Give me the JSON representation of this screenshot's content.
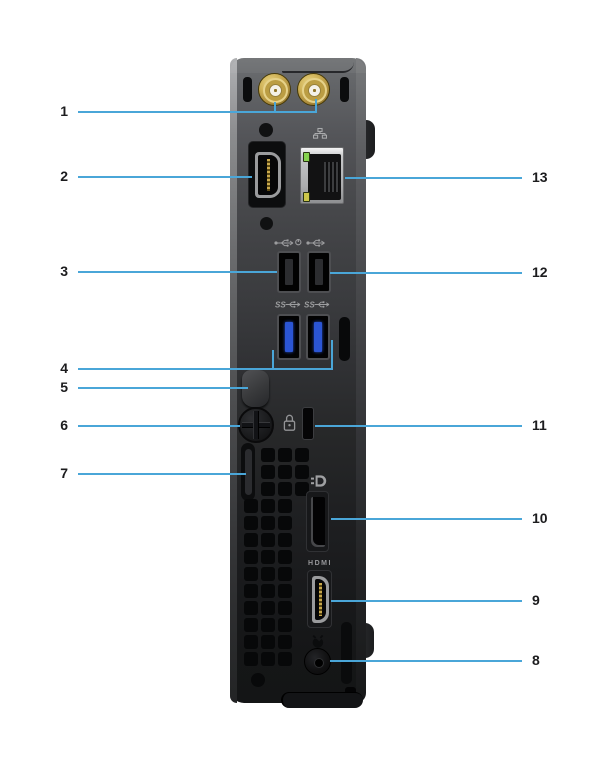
{
  "figure_type": "hardware-rear-panel-diagram",
  "labels": {
    "hdmi_label": "HDMI",
    "ss_label": "SS"
  },
  "colors": {
    "background": "#ffffff",
    "callout_line": "#4aa6d8",
    "callout_number": "#1c1c1e",
    "chassis_top": "#6e7072",
    "chassis_bottom": "#141516",
    "usb3_blue": "#2b55d4",
    "antenna_gold": "#c6a94e",
    "ethernet_led_green": "#86d24f",
    "ethernet_led_amber": "#ccc74a",
    "hdmi_pins_gold": "#c9a84c"
  },
  "icons": [
    "network-icon",
    "usb-icon",
    "usb-smart-power-icon",
    "usb3-ss-icon",
    "security-lock-icon",
    "displayport-icon",
    "power-plug-icon"
  ],
  "callouts": [
    {
      "number": "1",
      "side": "left",
      "y": 112,
      "x1": 78,
      "x2": 317,
      "stubs": [
        {
          "x": 274,
          "y1": 102,
          "y2": 112
        },
        {
          "x": 315,
          "y1": 99,
          "y2": 112
        }
      ],
      "target": "antenna-connectors"
    },
    {
      "number": "2",
      "side": "left",
      "y": 177,
      "x1": 78,
      "x2": 252,
      "stubs": [],
      "target": "optional-video-port"
    },
    {
      "number": "3",
      "side": "left",
      "y": 272,
      "x1": 78,
      "x2": 277,
      "stubs": [],
      "target": "usb2-port-left"
    },
    {
      "number": "4",
      "side": "left",
      "y": 369,
      "x1": 78,
      "x2": 333,
      "stubs": [
        {
          "x": 272,
          "y1": 350,
          "y2": 369
        },
        {
          "x": 331,
          "y1": 340,
          "y2": 369
        }
      ],
      "target": "usb3-ports"
    },
    {
      "number": "5",
      "side": "left",
      "y": 388,
      "x1": 78,
      "x2": 248,
      "stubs": [],
      "target": "cable-holder"
    },
    {
      "number": "6",
      "side": "left",
      "y": 426,
      "x1": 78,
      "x2": 240,
      "stubs": [],
      "target": "thumbscrew"
    },
    {
      "number": "7",
      "side": "left",
      "y": 474,
      "x1": 78,
      "x2": 246,
      "stubs": [],
      "target": "padlock-ring"
    },
    {
      "number": "8",
      "side": "right",
      "y": 661,
      "x1": 330,
      "x2": 522,
      "stubs": [],
      "target": "power-connector"
    },
    {
      "number": "9",
      "side": "right",
      "y": 601,
      "x1": 331,
      "x2": 522,
      "stubs": [],
      "target": "hdmi-port"
    },
    {
      "number": "10",
      "side": "right",
      "y": 519,
      "x1": 331,
      "x2": 522,
      "stubs": [],
      "target": "displayport"
    },
    {
      "number": "11",
      "side": "right",
      "y": 426,
      "x1": 315,
      "x2": 522,
      "stubs": [],
      "target": "kensington-lock-slot"
    },
    {
      "number": "12",
      "side": "right",
      "y": 273,
      "x1": 330,
      "x2": 522,
      "stubs": [],
      "target": "usb2-port-right"
    },
    {
      "number": "13",
      "side": "right",
      "y": 178,
      "x1": 345,
      "x2": 522,
      "stubs": [],
      "target": "ethernet-port"
    }
  ]
}
